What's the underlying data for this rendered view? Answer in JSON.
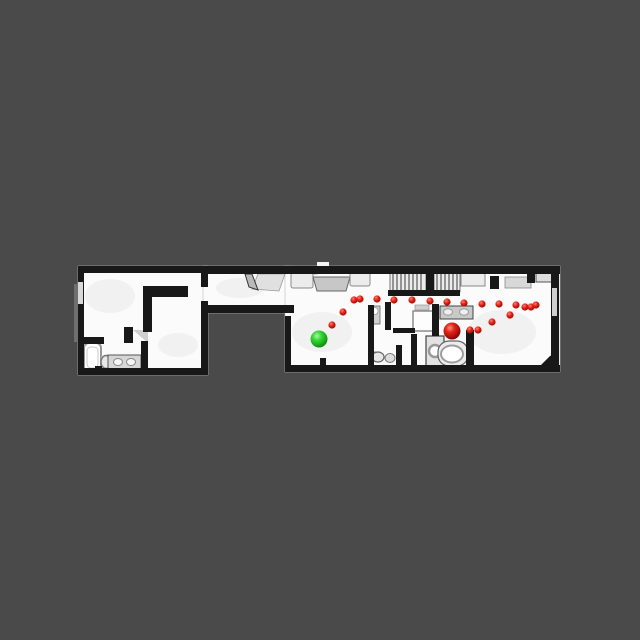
{
  "scene": {
    "background_color": "#4a4a4a",
    "floor_color": "#fbfbfb",
    "wall_color": "#181818",
    "furniture_color": "#d6d6d6"
  },
  "markers": {
    "start": {
      "x": 319,
      "y": 339,
      "radius": 8.5,
      "color": "#2fd32f"
    },
    "goal": {
      "x": 452,
      "y": 331,
      "radius": 8.5,
      "color": "#d62016"
    },
    "waypoints": {
      "color": "#d62016",
      "radius": 3.6,
      "points": [
        [
          332,
          325
        ],
        [
          343,
          312
        ],
        [
          354,
          300
        ],
        [
          360,
          299
        ],
        [
          377,
          299
        ],
        [
          394,
          300
        ],
        [
          412,
          300
        ],
        [
          430,
          301
        ],
        [
          447,
          302
        ],
        [
          464,
          303
        ],
        [
          482,
          304
        ],
        [
          499,
          304
        ],
        [
          516,
          305
        ],
        [
          525,
          307
        ],
        [
          531,
          307
        ],
        [
          536,
          305
        ],
        [
          510,
          315
        ],
        [
          492,
          322
        ],
        [
          478,
          330
        ],
        [
          470,
          330
        ]
      ]
    }
  }
}
